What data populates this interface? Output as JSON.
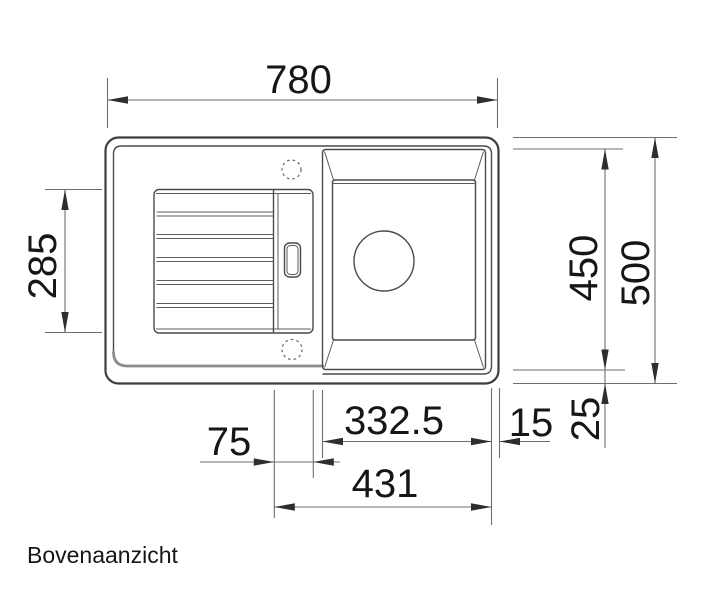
{
  "drawing": {
    "title": "Bovenaanzicht",
    "dimensions": {
      "overall_width": "780",
      "recess_height": "285",
      "basin_zone_height": "450",
      "overall_depth": "500",
      "bowl_to_rim_width": "332.5",
      "right_rim_width": "15",
      "bottom_rim_height": "25",
      "tray_strip_width": "75",
      "bowl_area_total_width": "431"
    },
    "colors": {
      "outline": "#3e3e3e",
      "detail_line": "#5c5c5c",
      "dimension_line": "#6f6f6f",
      "arrow": "#2e2e2e",
      "text": "#161616",
      "background": "#ffffff"
    }
  }
}
